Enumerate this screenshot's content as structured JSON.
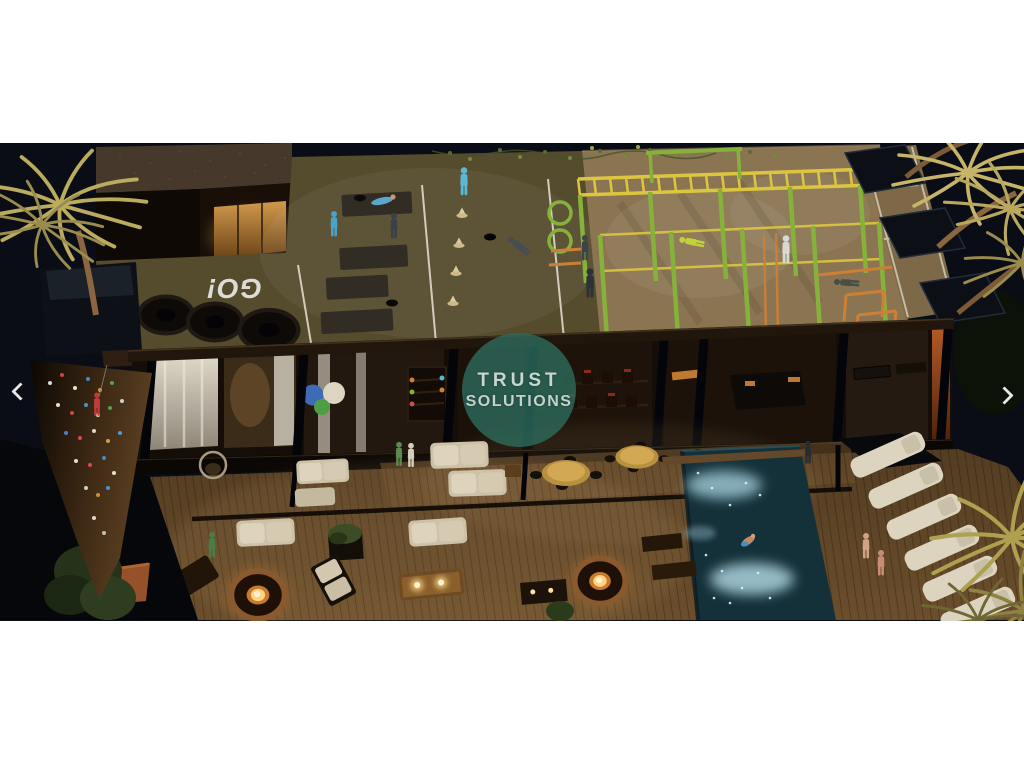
{
  "carousel": {
    "prev_icon": "chevron-left",
    "next_icon": "chevron-right"
  },
  "render": {
    "floor_text": "GO!",
    "watermark": {
      "line1": "TRUST",
      "line2": "SOLUTIONS"
    }
  },
  "colors": {
    "page_background": "#ffffff",
    "night_sky": "#0a0d16",
    "watermark_teal": "rgba(45,110,95,0.78)",
    "rooftop_turf": "#554b2d",
    "rooftop_concrete": "#8b7452",
    "frame_green": "#86b23c",
    "frame_yellow": "#dcc63f",
    "frame_orange": "#cd7f36",
    "deck_wood": "#6b4e2c",
    "pool_water": "#143039",
    "lounger_cream": "#ddd4bf",
    "arrow_white": "#f3f3f1"
  }
}
